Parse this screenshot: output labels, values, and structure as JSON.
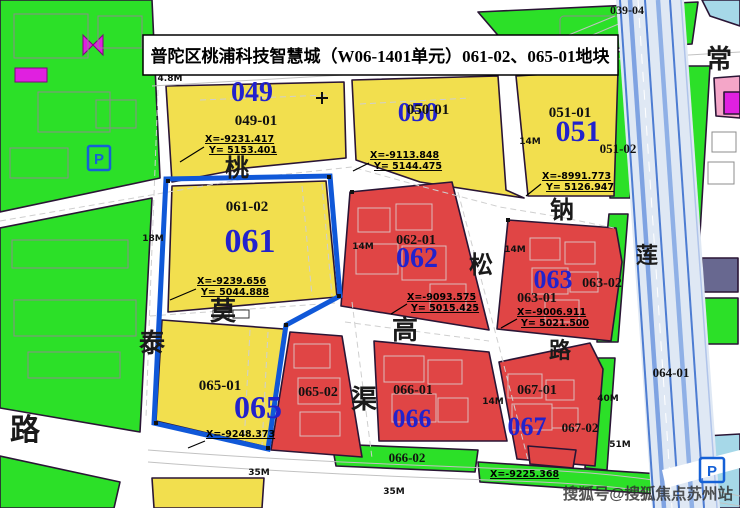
{
  "title": "普陀区桃浦科技智慧城（W06-1401单元）061-02、065-01地块",
  "watermark": "搜狐号@搜狐焦点苏州站",
  "parcels": {
    "p039": {
      "sub": "039-04"
    },
    "p049": {
      "num": "049",
      "sub": "049-01",
      "cx": "X=-9231.417",
      "cy": "Y= 5153.401"
    },
    "p050": {
      "num": "050",
      "sub": "050-01",
      "cx": "X=-9113.848",
      "cy": "Y= 5144.475"
    },
    "p051": {
      "num": "051",
      "sub": "051-01",
      "sub2": "051-02",
      "cx": "X=-8991.773",
      "cy": "Y= 5126.947"
    },
    "p061": {
      "num": "061",
      "sub": "061-02",
      "cx": "X=-9239.656",
      "cy": "Y= 5044.888"
    },
    "p062": {
      "num": "062",
      "sub": "062-01",
      "cx": "X=-9093.575",
      "cy": "Y= 5015.425"
    },
    "p063": {
      "num": "063",
      "sub": "063-01",
      "sub2": "063-02",
      "cx": "X=-9006.911",
      "cy": "Y= 5021.500"
    },
    "p064": {
      "sub": "064-01"
    },
    "p065": {
      "num": "065",
      "sub": "065-01",
      "sub2": "065-02",
      "cx": "X=-9248.373"
    },
    "p066": {
      "num": "066",
      "sub": "066-01",
      "sub2": "066-02",
      "cx": "X=-9225.368"
    },
    "p067": {
      "num": "067",
      "sub": "067-01",
      "sub2": "067-02"
    }
  },
  "roads": {
    "tao": "桃",
    "tai": "泰",
    "mo": "莫",
    "gao": "高",
    "qu": "渠",
    "song": "松",
    "lu": "路",
    "na": "钠",
    "lian": "莲",
    "chang": "常"
  },
  "dims": {
    "m48": "4.8M",
    "m14": "14M",
    "m18": "18M",
    "m35": "35M",
    "m40": "40M",
    "m51": "51M"
  },
  "icons": {
    "parking": "P"
  },
  "colors": {
    "green": "#2ce028",
    "yellow": "#f2df4e",
    "red": "#e04545",
    "blue_outline": "#1058d8",
    "num_blue": "#2222cc",
    "pink": "#f4a6c8",
    "magenta": "#e020e0",
    "water": "#a6d8e8"
  }
}
